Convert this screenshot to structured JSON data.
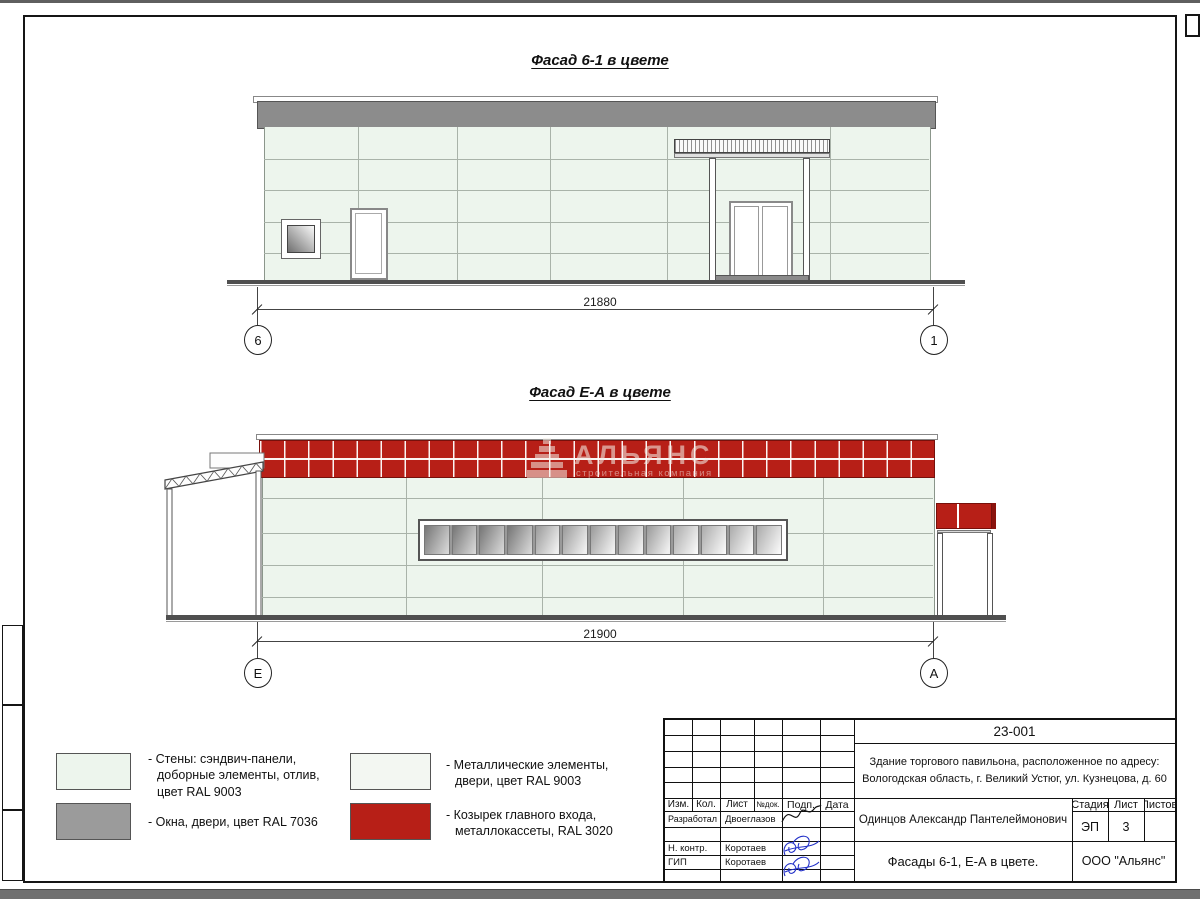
{
  "page": {
    "facades": [
      {
        "title": "Фасад 6-1 в цвете",
        "dimension": "21880",
        "axis_left": "6",
        "axis_right": "1"
      },
      {
        "title": "Фасад Е-А в цвете",
        "dimension": "21900",
        "axis_left": "Е",
        "axis_right": "А"
      }
    ],
    "watermark": {
      "name": "АЛЬЯНС",
      "subtitle": "строительная компания"
    },
    "legend": [
      {
        "swatch": "#edf5ed",
        "label": "- Стены: сэндвич-панели,\nдоборные элементы, отлив,\nцвет RAL 9003"
      },
      {
        "swatch": "#9b9b9b",
        "label": "- Окна, двери, цвет RAL 7036"
      },
      {
        "swatch": "#f3f7f2",
        "label": "- Металлические элементы,\nдвери, цвет RAL 9003"
      },
      {
        "swatch": "#b71f17",
        "label": "- Козырек главного входа,\nметаллокассеты, RAL 3020"
      }
    ],
    "titleblock": {
      "code": "23-001",
      "address_line1": "Здание торгового павильона, расположенное по адресу:",
      "address_line2": "Вологодская область, г. Великий Устюг, ул. Кузнецова, д. 60",
      "header_cols": [
        "Изм.",
        "Кол.",
        "Лист",
        "№док.",
        "Подп.",
        "Дата"
      ],
      "rows": [
        {
          "role": "Разработал",
          "name": "Двоеглазов"
        },
        {
          "role": "Н. контр.",
          "name": "Коротаев"
        },
        {
          "role": "ГИП",
          "name": "Коротаев"
        }
      ],
      "author": "Одинцов Александр Пантелеймонович",
      "stage_headers": [
        "Стадия",
        "Лист",
        "Листов"
      ],
      "stage": "ЭП",
      "sheet_no": "3",
      "sheets_total": "",
      "doc_title": "Фасады 6-1, Е-А в цвете.",
      "company": "ООО \"Альянс\""
    },
    "colors": {
      "wall": "#edf5ed",
      "metal": "#f3f7f2",
      "window_gray": "#9b9b9b",
      "red": "#b71f17",
      "parapet": "#8c8c8c",
      "ground": "#4f4f4f"
    }
  }
}
